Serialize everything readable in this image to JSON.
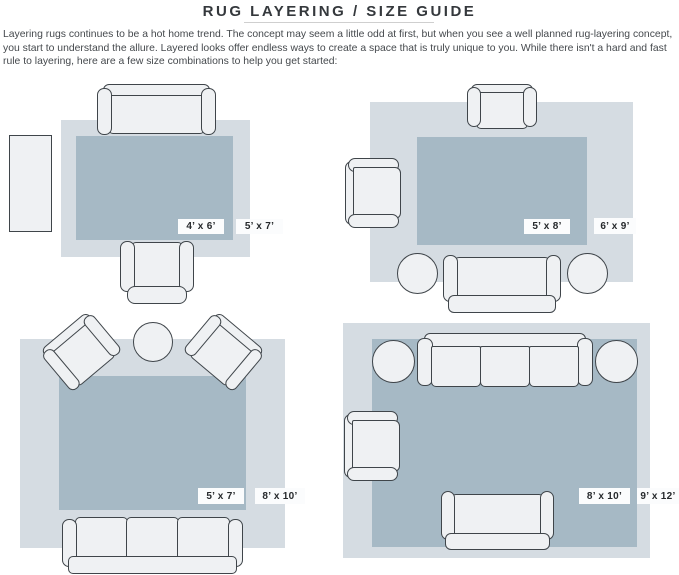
{
  "page": {
    "title": "RUG LAYERING / SIZE GUIDE",
    "intro": "Layering rugs continues to be a hot home trend. The concept may seem a little odd at first, but when you see a well planned rug-layering concept, you start to understand the allure. Layered looks offer endless ways to create a space that is truly unique to you. While there isn't a hard and fast rule to layering, here are a few size combinations to help you get started:"
  },
  "colors": {
    "inner_rug": "#a6b9c5",
    "outer_rug": "#d5dce2",
    "furniture_fill": "#eff1f3",
    "furniture_outline": "#3f454a",
    "label_bg": "#fbfcfd",
    "label_text": "#26292c",
    "title_text": "#34383c",
    "body_text": "#45494d"
  },
  "diagrams": [
    {
      "inner_rug_label": "4’ x 6’",
      "outer_rug_label": "5’ x 7’",
      "furniture": [
        "sofa",
        "armchair",
        "console-table"
      ]
    },
    {
      "inner_rug_label": "5’ x 8’",
      "outer_rug_label": "6’ x 9’",
      "furniture": [
        "armchair",
        "armchair",
        "sofa",
        "round-ottoman",
        "round-ottoman"
      ]
    },
    {
      "inner_rug_label": "5’ x 7’",
      "outer_rug_label": "8’ x 10’",
      "furniture": [
        "armchair",
        "armchair",
        "round-table",
        "three-seat-sofa"
      ]
    },
    {
      "inner_rug_label": "8’ x 10’",
      "outer_rug_label": "9’ x 12’",
      "furniture": [
        "three-seat-sofa",
        "loveseat",
        "armchair",
        "round-ottoman",
        "round-ottoman"
      ]
    }
  ]
}
